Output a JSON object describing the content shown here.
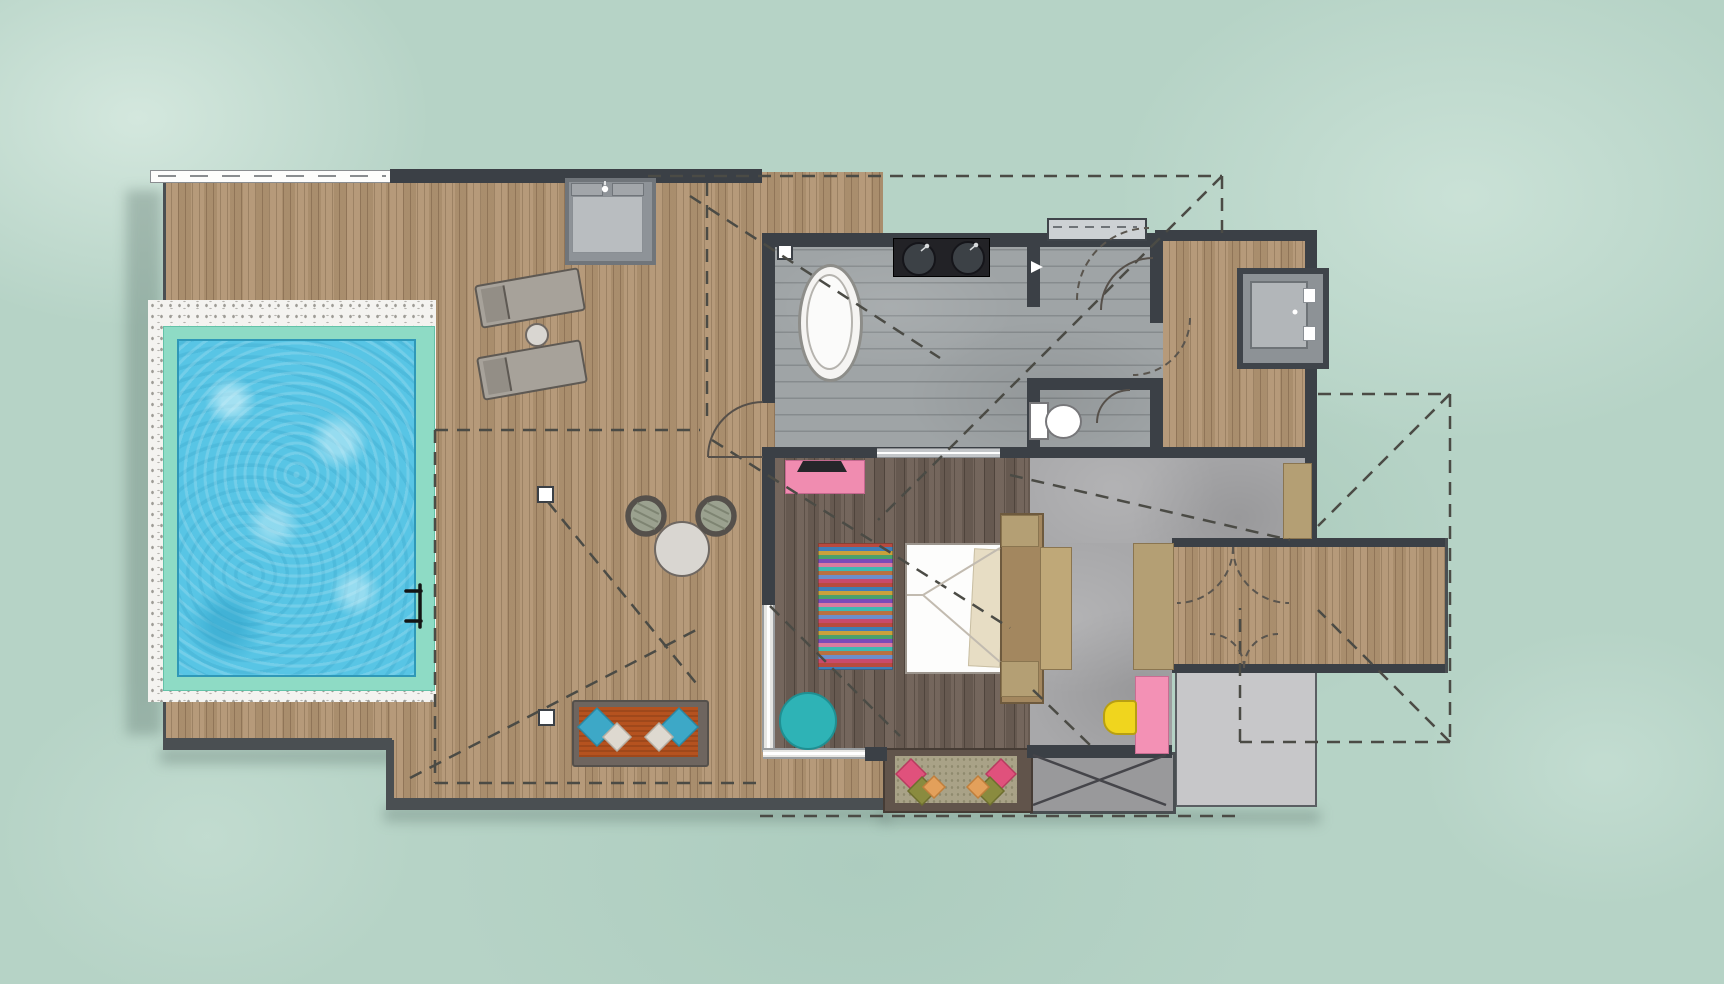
{
  "meta": {
    "type": "architectural-floor-plan",
    "subject": "Overwater pool villa, top-down plan on turquoise lagoon water",
    "visible_text": []
  },
  "palette": {
    "lagoon_water": "#b6d3c6",
    "pool_water": "#58c5e5",
    "pool_coping": "#8edbc5",
    "stone_border": "#f4f3f0",
    "deck_wood": "#b29573",
    "bedroom_wood": "#6e6056",
    "bath_stone": "#9fa4a6",
    "concrete": "#a8a8aa",
    "wall_dark": "#3b4046",
    "landing_gray": "#c7c7c9",
    "platform_gray": "#99999b",
    "net_mat": "#a9a287",
    "accent_pink": "#f08cb0",
    "accent_pink_desk": "#f391b5",
    "accent_yellow": "#f0d51e",
    "accent_teal_pouf": "#2eb3b6",
    "accent_orange_cushion": "#b5521f",
    "pillow_teal": "#3da8c7",
    "pillow_pink": "#e0517c",
    "pillow_olive": "#8a8b3f",
    "pillow_peach": "#e3a05b",
    "tan_furniture": "#b49f74",
    "headboard_tan": "#a3875f",
    "white_fixture": "#f5f4f2"
  },
  "rooms": [
    {
      "id": "pool-deck",
      "label": "sun-deck"
    },
    {
      "id": "pool",
      "label": "private-pool"
    },
    {
      "id": "bathroom",
      "label": "bathroom"
    },
    {
      "id": "shower-room",
      "label": "shower-room"
    },
    {
      "id": "wc",
      "label": "wc"
    },
    {
      "id": "outdoor-shower-deck",
      "label": "outdoor-shower-deck"
    },
    {
      "id": "bedroom",
      "label": "bedroom"
    },
    {
      "id": "dressing-entry",
      "label": "dressing-entry-hall"
    },
    {
      "id": "entry-walkway",
      "label": "entry-walkway"
    },
    {
      "id": "net-lounge",
      "label": "overwater-net-lounge"
    },
    {
      "id": "stair-platform",
      "label": "stair-platform"
    },
    {
      "id": "lower-landing",
      "label": "lower-landing"
    }
  ],
  "furniture": [
    "sun-lounger-pair",
    "lounger-side-table",
    "deck-shower-pad",
    "freestanding-bathtub",
    "double-basin-vanity",
    "toilet",
    "shower-niche-shelf",
    "outdoor-shower-tray",
    "round-dining-table",
    "wicker-armchair-pair",
    "daybed-with-diamond-pillows",
    "pink-media-console-with-tv",
    "striped-multicolor-rug",
    "double-bed-white-duvet",
    "headboard-with-nightstands",
    "bedside-bench",
    "teal-pouf",
    "wardrobe-panels",
    "pink-desk",
    "yellow-stool",
    "net-lounge-cushions",
    "pool-ladder"
  ],
  "features": [
    "dashed-roof-overhang-outlines",
    "door-swing-arcs",
    "roof-support-posts",
    "bottom-shadows"
  ]
}
